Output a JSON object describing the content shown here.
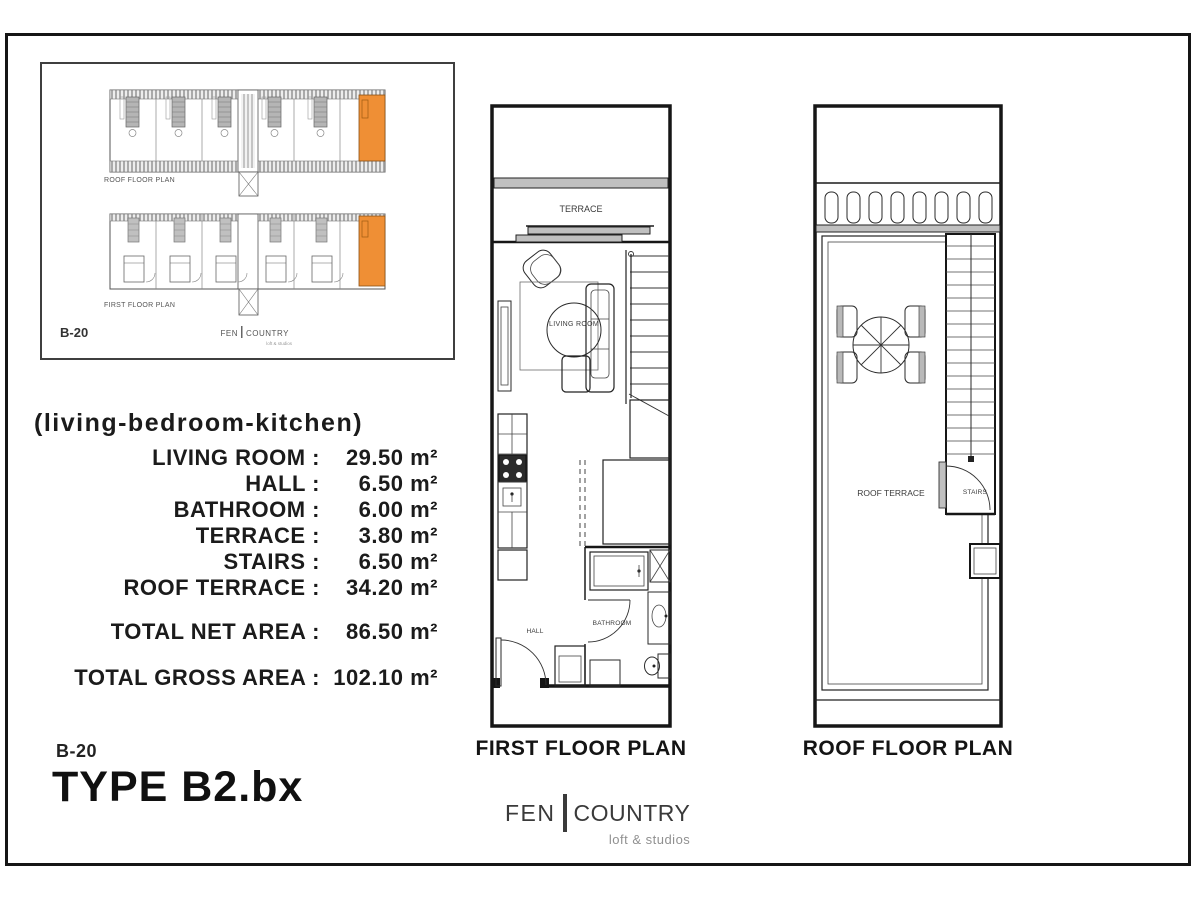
{
  "key_plan": {
    "roof_strip_label": "ROOF FLOOR PLAN",
    "first_strip_label": "FIRST FLOOR PLAN",
    "unit_code": "B-20",
    "logo": {
      "fen": "FEN",
      "country": "COUNTRY",
      "tagline": "loft & studios"
    }
  },
  "areas": {
    "subtitle": "(living-bedroom-kitchen)",
    "rows": [
      {
        "label": "LIVING ROOM :",
        "value": "29.50 m²"
      },
      {
        "label": "HALL :",
        "value": "6.50 m²"
      },
      {
        "label": "BATHROOM :",
        "value": "6.00 m²"
      },
      {
        "label": "TERRACE :",
        "value": "3.80 m²"
      },
      {
        "label": "STAIRS :",
        "value": "6.50 m²"
      },
      {
        "label": "ROOF TERRACE :",
        "value": "34.20 m²"
      }
    ],
    "totals": [
      {
        "label": "TOTAL NET AREA :",
        "value": "86.50 m²"
      },
      {
        "label": "TOTAL GROSS AREA :",
        "value": "102.10 m²"
      }
    ]
  },
  "plans": {
    "first": {
      "title": "FIRST FLOOR PLAN",
      "labels": {
        "terrace": "TERRACE",
        "living_room": "LIVING ROOM",
        "hall": "HALL",
        "bathroom": "BATHROOM"
      }
    },
    "roof": {
      "title": "ROOF FLOOR PLAN",
      "labels": {
        "roof_terrace": "ROOF TERRACE",
        "stairs": "STAIRS"
      }
    }
  },
  "footer": {
    "unit_code": "B-20",
    "type_label": "TYPE B2.bx",
    "logo": {
      "fen": "FEN",
      "country": "COUNTRY",
      "tagline": "loft & studios"
    }
  },
  "colors": {
    "highlight_orange": "#ef8f35",
    "band_gray": "#c0c0c0",
    "line_black": "#161616"
  }
}
